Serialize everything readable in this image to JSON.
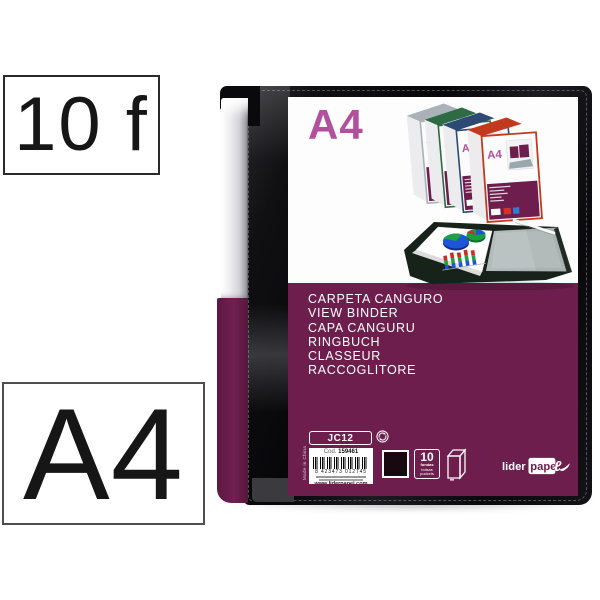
{
  "product_badges": {
    "sheet_count": "10 f",
    "paper_size": "A4"
  },
  "binder_label": {
    "format": "A4",
    "mini_format": "A4",
    "product_names": [
      "CARPETA CANGURO",
      "VIEW BINDER",
      "CAPA CANGURU",
      "RINGBUCH",
      "CLASSEUR",
      "RACCOGLITORE"
    ],
    "sku": "JC12",
    "code_label": "Cod.",
    "code_value": "159461",
    "ean": "8 423473 012745",
    "website": "www.liderpapel.com",
    "origin": "Made in China",
    "pockets_count": "10",
    "pockets_words": [
      "fundas",
      "bolsas",
      "pockets"
    ],
    "brand_part1": "lider",
    "brand_part2": "pape",
    "brand_swash": "ℓ"
  },
  "colors": {
    "label_purple": "#6D1E4D",
    "format_magenta": "#B1509C",
    "cover_black": "#0B0B0E",
    "clip_silver": "#D8D8DC",
    "spine_gray": "#AAB1B9",
    "spine_green": "#2E6B45",
    "spine_navy": "#2C4A74",
    "spine_red": "#C23A1E"
  }
}
